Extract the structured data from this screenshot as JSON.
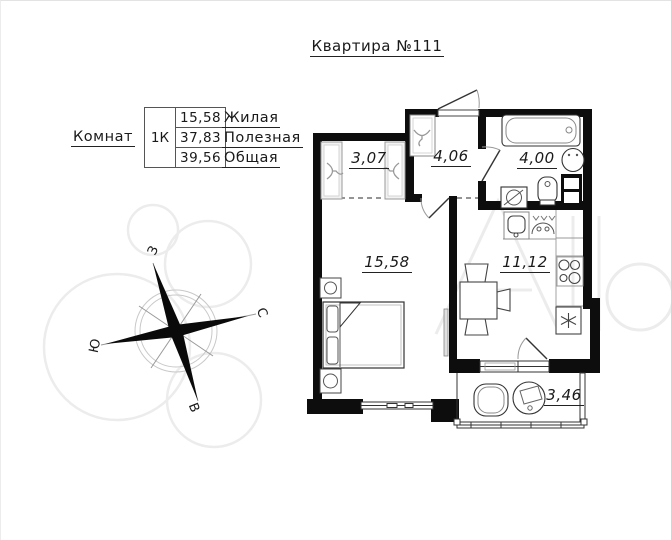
{
  "title": "Квартира №111",
  "legend": {
    "rooms_label": "Комнат",
    "unit": "1К",
    "rows": [
      {
        "value": "15,58",
        "label": "Жилая"
      },
      {
        "value": "37,83",
        "label": "Полезная"
      },
      {
        "value": "39,56",
        "label": "Общая"
      }
    ]
  },
  "rooms": {
    "wardrobe": "3,07",
    "hallway": "4,06",
    "bathroom": "4,00",
    "living_room": "15,58",
    "kitchen": "11,12",
    "balcony": "3,46"
  },
  "compass": {
    "west": "З",
    "north": "С",
    "south": "Ю",
    "east": "В"
  },
  "watermark": {
    "brand": "Avito"
  },
  "colors": {
    "wall": "#0d0d0d",
    "line": "#333333",
    "light_line": "#999999",
    "watermark": "#ececec"
  }
}
